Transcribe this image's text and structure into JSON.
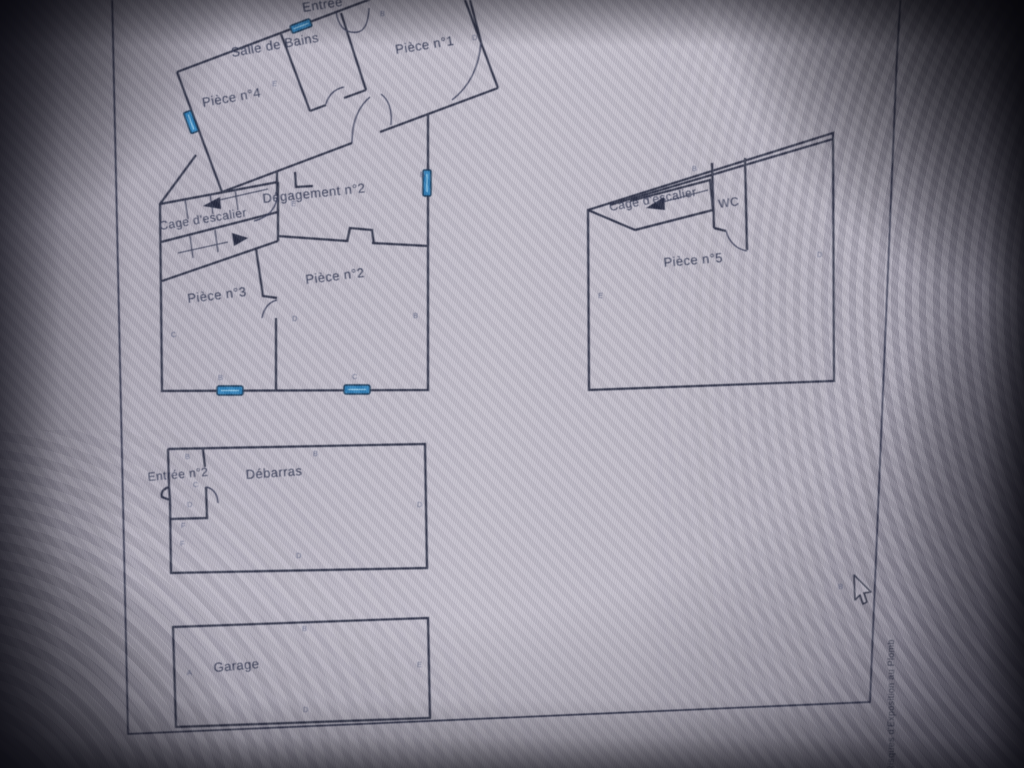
{
  "plan": {
    "rooms": {
      "entree": "Entrée",
      "salle_de_bains": "Salle de Bains",
      "piece1": "Pièce n°1",
      "piece4": "Pièce n°4",
      "degagement2": "Dégagement n°2",
      "cage_escalier_main": "Cage d'escalier",
      "piece2": "Pièce n°2",
      "piece3": "Pièce n°3",
      "cage_escalier_annex": "Cage d'escalier",
      "wc": "WC",
      "piece5": "Pièce n°5",
      "entree2": "Entrée n°2",
      "debarras": "Débarras",
      "garage": "Garage"
    },
    "side_text": "des Risques d'Exposition au Plomb",
    "colors": {
      "wall": "#2b2f42",
      "window_fill": "#2e7fb8",
      "label": "#30364e"
    },
    "point_labels": [
      {
        "t": "B",
        "x": 380,
        "y": 16
      },
      {
        "t": "D",
        "x": 472,
        "y": 40
      },
      {
        "t": "E",
        "x": 272,
        "y": 86
      },
      {
        "t": "E",
        "x": 291,
        "y": 206
      },
      {
        "t": "B",
        "x": 420,
        "y": 177
      },
      {
        "t": "B",
        "x": 413,
        "y": 318
      },
      {
        "t": "D",
        "x": 292,
        "y": 321
      },
      {
        "t": "C",
        "x": 171,
        "y": 337
      },
      {
        "t": "B",
        "x": 218,
        "y": 380
      },
      {
        "t": "C",
        "x": 352,
        "y": 379
      },
      {
        "t": "B",
        "x": 185,
        "y": 459
      },
      {
        "t": "B",
        "x": 313,
        "y": 456
      },
      {
        "t": "C",
        "x": 193,
        "y": 487
      },
      {
        "t": "D",
        "x": 187,
        "y": 507
      },
      {
        "t": "D",
        "x": 417,
        "y": 507
      },
      {
        "t": "F",
        "x": 181,
        "y": 528
      },
      {
        "t": "F",
        "x": 180,
        "y": 546
      },
      {
        "t": "D",
        "x": 296,
        "y": 558
      },
      {
        "t": "B",
        "x": 302,
        "y": 631
      },
      {
        "t": "A",
        "x": 187,
        "y": 675
      },
      {
        "t": "E",
        "x": 417,
        "y": 667
      },
      {
        "t": "D",
        "x": 303,
        "y": 712
      },
      {
        "t": "D",
        "x": 817,
        "y": 257
      },
      {
        "t": "E",
        "x": 598,
        "y": 298
      },
      {
        "t": "B",
        "x": 692,
        "y": 171
      },
      {
        "t": "B",
        "x": 838,
        "y": 589
      }
    ]
  }
}
